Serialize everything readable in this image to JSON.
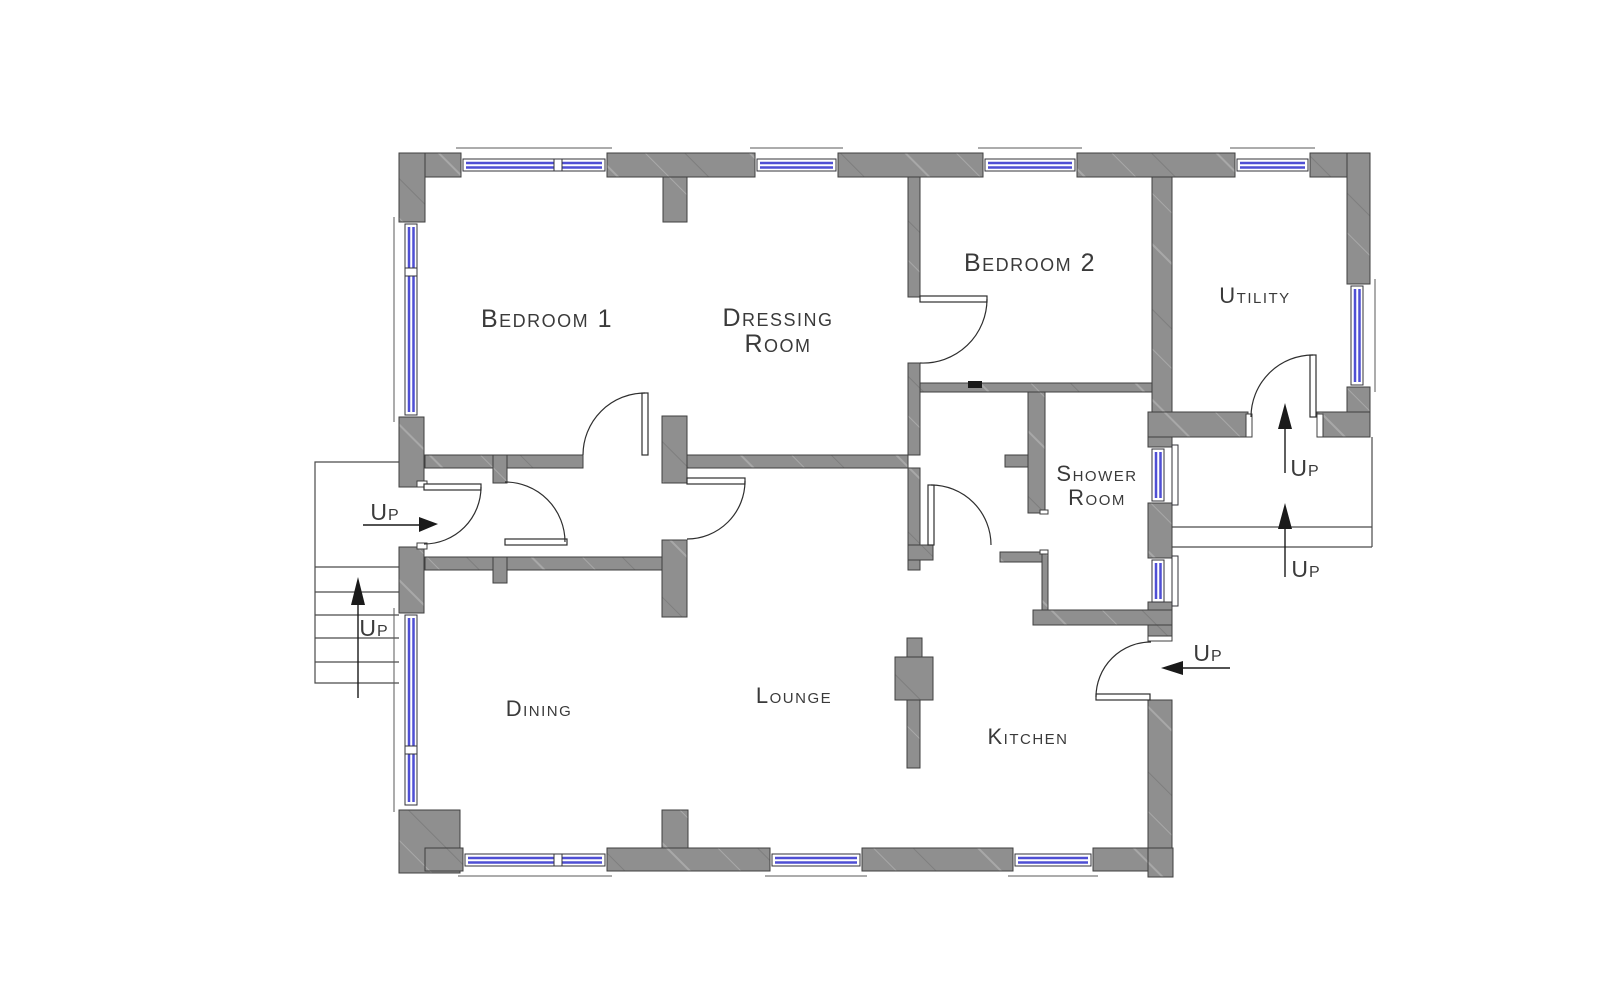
{
  "rooms": {
    "bedroom1": {
      "label": "Bedroom 1"
    },
    "dressing": {
      "line1": "Dressing",
      "line2": "Room"
    },
    "bedroom2": {
      "label": "Bedroom 2"
    },
    "utility": {
      "label": "Utility"
    },
    "shower": {
      "line1": "Shower",
      "line2": "Room"
    },
    "dining": {
      "label": "Dining"
    },
    "lounge": {
      "label": "Lounge"
    },
    "kitchen": {
      "label": "Kitchen"
    }
  },
  "up_labels": {
    "entry": "Up",
    "stairs_left": "Up",
    "landing_upper": "Up",
    "landing_lower": "Up",
    "kitchen_entry": "Up"
  },
  "colors": {
    "wall": "#8f8f8f",
    "wall_hatch_light": "#a8a8a8",
    "wall_hatch_dark": "#7e7e7e",
    "window_glass": "#4f4fd4",
    "text": "#3a3a3a",
    "line": "#2e2e2e"
  }
}
